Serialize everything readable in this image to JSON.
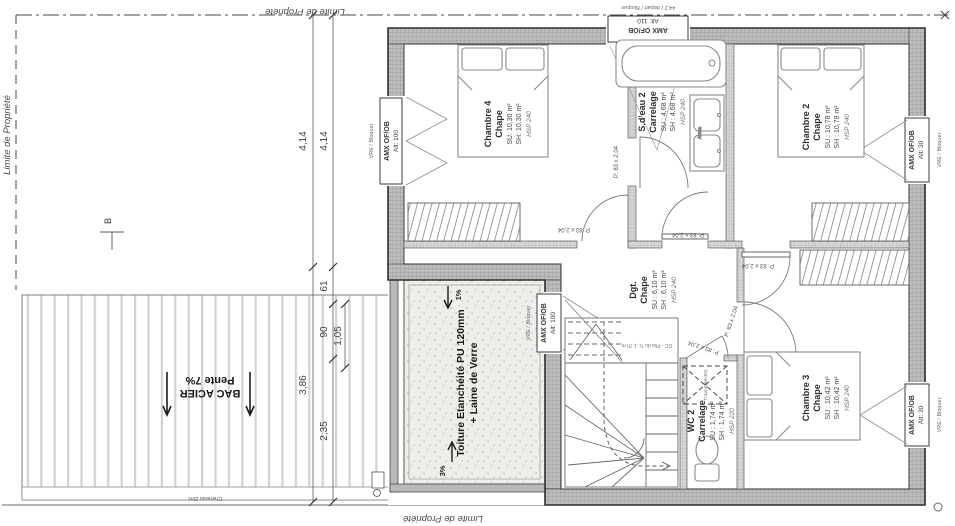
{
  "boundary": {
    "left": "Limite de Propriété",
    "top": "Limite de Propriété",
    "bottom": "Limite de Propriété"
  },
  "marker_b": "B",
  "dims": {
    "d414a": "4,14",
    "d414b": "4,14",
    "d61": "61",
    "d90": "90",
    "d105": "1,05",
    "d386": "3,86",
    "d235": "2,35"
  },
  "bac_acier": {
    "title": "BAC ACIER",
    "slope": "Pente 7%",
    "gutter": "Cheneau Zinc"
  },
  "toiture": {
    "line1": "Toiture Etanchéité PU 120mm",
    "line2": "+ Laine de Verre",
    "slope_top": "1%",
    "slope_bottom": "3%"
  },
  "rooms": [
    {
      "name": "Chambre 4",
      "finish": "Chape",
      "su": "SU: 10,30 m²",
      "sh": "SH: 10,30 m²",
      "hsp": "HSP 240"
    },
    {
      "name": "S.d'eau 2",
      "finish": "Carrelage",
      "su": "SU : 4,68 m²",
      "sh": "SH : 4,68 m²",
      "hsp": "HSP 240"
    },
    {
      "name": "Chambre 2",
      "finish": "Chape",
      "su": "SU : 10,78 m²",
      "sh": "SH : 10,78 m²",
      "hsp": "HSP 240"
    },
    {
      "name": "Dgt.",
      "finish": "Chape",
      "su": "SU : 6,10 m²",
      "sh": "SH : 6,10 m²",
      "hsp": "HSP 240"
    },
    {
      "name": "WC 2",
      "finish": "Carrelage",
      "su": "SU : 1,74 m²",
      "sh": "SH : 1,74 m²",
      "hsp": "HSP 220"
    },
    {
      "name": "Chambre 3",
      "finish": "Chape",
      "su": "SU : 10,42 m²",
      "sh": "SH : 10,42 m²",
      "hsp": "HSP 240"
    }
  ],
  "windows": [
    {
      "name": "AMX OF/OB",
      "alt": "Alt: 100",
      "note": "VRE / Bloquer"
    },
    {
      "name": "AMX OF/OB",
      "alt": "Alt: 110",
      "note": "44.2 / départ / Bloquer"
    },
    {
      "name": "AMX OF/OB",
      "alt": "Alt: 30",
      "note": "VRE / Bloquer"
    },
    {
      "name": "AMX OF/OB",
      "alt": "Alt: 100",
      "note": "VRE / Bloquer"
    },
    {
      "name": "AMX OF/OB",
      "alt": "Alt: 30",
      "note": "VRE / Bloquer"
    }
  ],
  "door_label": "P: 83 x 2,04",
  "stairs_note": "GC - Plia du Tr. 1,70 m",
  "trappe_label": "Trappe(60x60)",
  "vanity_label": "Atena"
}
